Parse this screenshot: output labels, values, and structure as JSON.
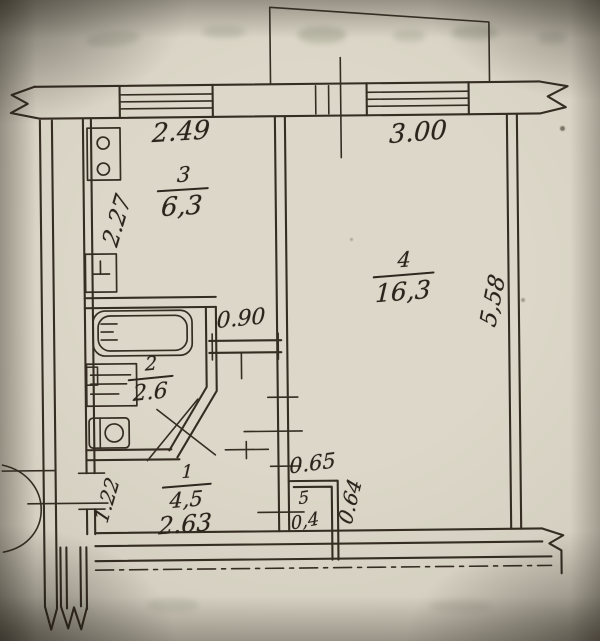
{
  "plan": {
    "rooms": [
      {
        "id": "kitchen",
        "number": "3",
        "area": "6,3"
      },
      {
        "id": "living",
        "number": "4",
        "area": "16,3"
      },
      {
        "id": "bathroom",
        "number": "2",
        "area": "2.6"
      },
      {
        "id": "hall",
        "number": "1",
        "area": "4,5"
      },
      {
        "id": "closet",
        "number": "5",
        "area": "0,4"
      }
    ],
    "dimensions": {
      "kitchen_window": "2.49",
      "living_window": "3.00",
      "kitchen_depth": "2.27",
      "living_depth": "5,58",
      "kitchen_door": "0.90",
      "hall_width": "2.63",
      "entry_width": "1.22",
      "closet_width": "0.65",
      "closet_depth": "0.64"
    },
    "colors": {
      "paper": "#d6d1c3",
      "ink": "#2f2720"
    }
  }
}
